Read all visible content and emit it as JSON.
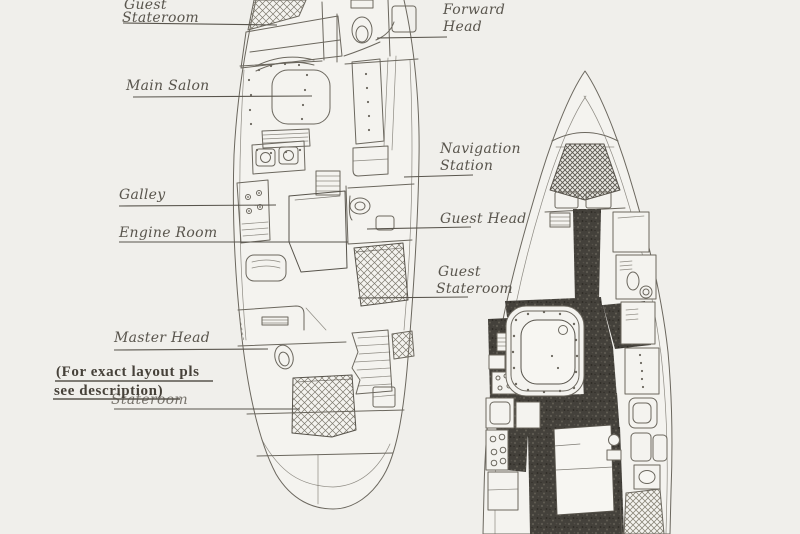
{
  "document": {
    "type": "scanned sailing-yacht interior layout diagram",
    "views": [
      "accommodation plan (left hull)",
      "deck plan (right hull)"
    ]
  },
  "labels": {
    "guest_stateroom_fwd": {
      "line1": "Guest",
      "line2": "Stateroom"
    },
    "main_salon": {
      "text": "Main Salon"
    },
    "forward_head": {
      "line1": "Forward",
      "line2": "Head"
    },
    "navigation_station": {
      "line1": "Navigation",
      "line2": "Station"
    },
    "guest_head": {
      "text": "Guest Head"
    },
    "guest_stateroom_aft": {
      "line1": "Guest",
      "line2": "Stateroom"
    },
    "galley": {
      "text": "Galley"
    },
    "engine_room": {
      "text": "Engine Room"
    },
    "master_head": {
      "text": "Master Head"
    },
    "note": {
      "line1": "(For exact layout pls",
      "line2": "see description)"
    },
    "master_stateroom_overlap": {
      "text": "Stateroom"
    }
  },
  "colors": {
    "paper": "#f0efeb",
    "paper2": "#f4f3ef",
    "ink": "#6b675e",
    "ink_dark": "#57534b",
    "label_ink": "#59554d",
    "walkway": "#44413b"
  }
}
